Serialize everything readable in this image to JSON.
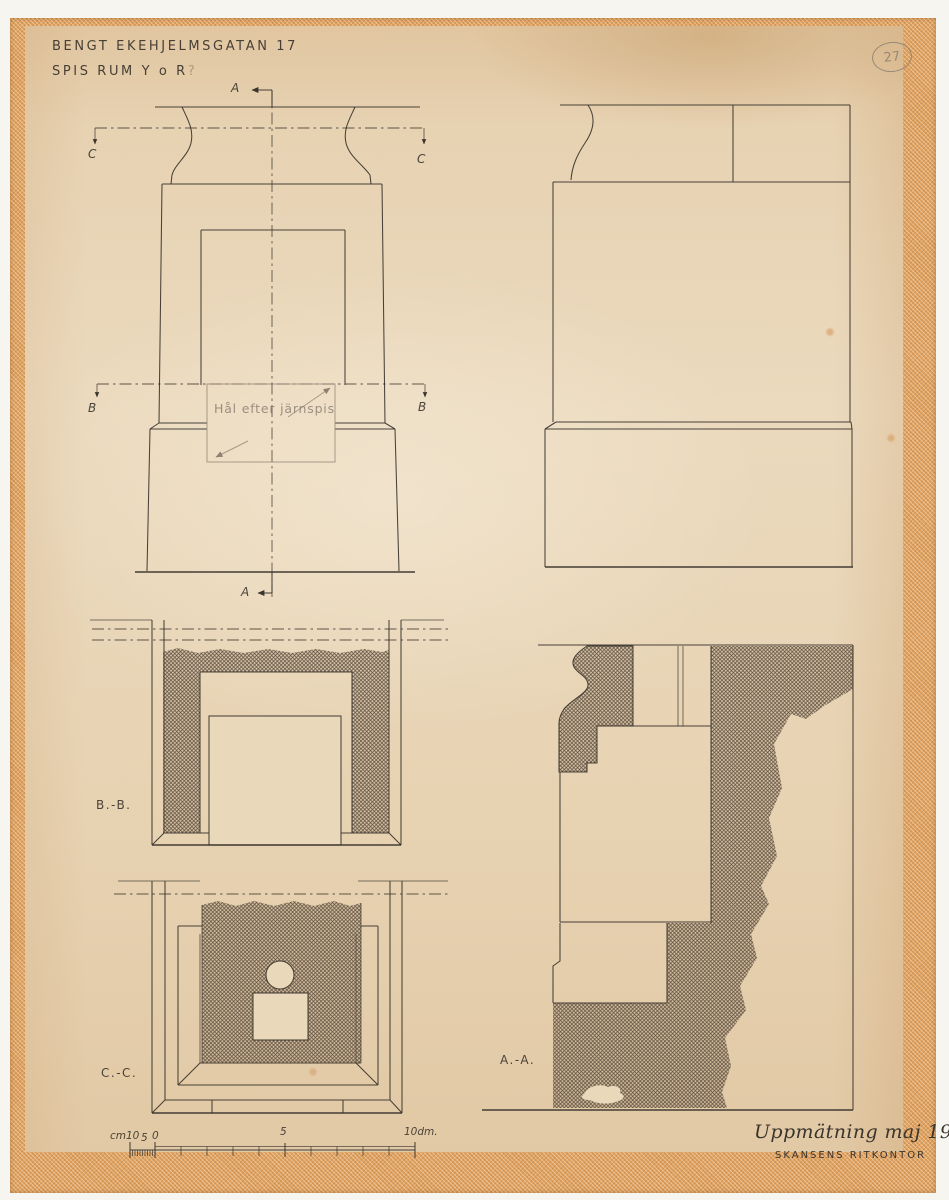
{
  "colors": {
    "page": "#f7f5f0",
    "paper": "#e9d6b8",
    "tape": "#dfa261",
    "ink": "#3a342c",
    "pencil": "#8d8173",
    "pencil-light": "#a6998a",
    "stain": "#b5917a",
    "hatch": "#5a4c3c"
  },
  "stamp": {
    "number": "27"
  },
  "header": {
    "title_line1": "BENGT EKEHJELMSGATAN 17",
    "title_line2": "SPIS RUM Y o R",
    "title_query": "?"
  },
  "front_elevation": {
    "note": "Hål efter järnspis",
    "cut_a_top": "A",
    "cut_a_bottom": "A",
    "cut_b_left": "B",
    "cut_b_right": "B",
    "cut_c_left": "C",
    "cut_c_right": "C"
  },
  "sections": {
    "bb": "B.-B.",
    "cc": "C.-C.",
    "aa": "A.-A."
  },
  "scale_bar": {
    "cm_label": "cm10",
    "cm_mid": "5",
    "cm_zero": "0",
    "dm_mid": "5",
    "dm_right": "10dm."
  },
  "footer": {
    "survey": "Uppmätning maj 1938",
    "office": "SKANSENS RITKONTOR"
  }
}
